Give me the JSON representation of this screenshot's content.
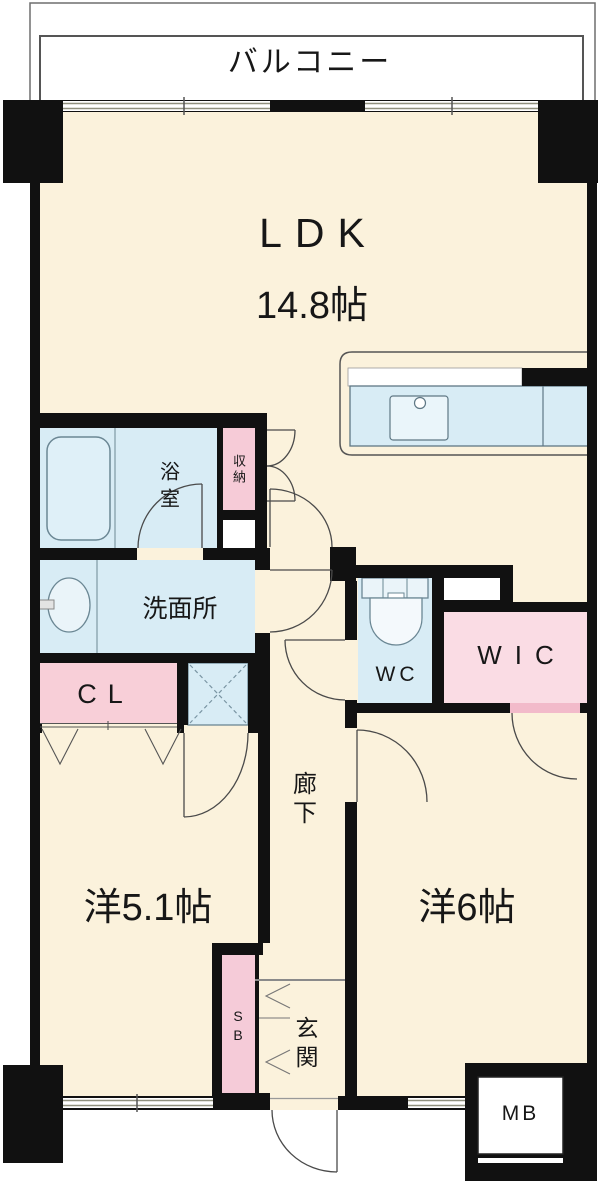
{
  "floor_plan": {
    "title": "apartment-floor-plan",
    "balcony": {
      "label": "バルコニー"
    },
    "ldk": {
      "label": "LDK",
      "size": "14.8帖"
    },
    "bathroom": {
      "label": "浴室"
    },
    "storage": {
      "label": "収納"
    },
    "washroom": {
      "label": "洗面所"
    },
    "closet": {
      "label": "CL"
    },
    "toilet": {
      "label": "WC"
    },
    "walk_in_closet": {
      "label": "WIC"
    },
    "corridor": {
      "label": "廊下"
    },
    "western_room_5_1": {
      "label": "洋5.1帖"
    },
    "entrance": {
      "label": "玄関"
    },
    "shoe_box": {
      "label": "SB"
    },
    "western_room_6": {
      "label": "洋6帖"
    },
    "meter_box": {
      "label": "MB"
    },
    "colors": {
      "wall": "#111111",
      "floor": "#FBF2DC",
      "wet_area_blue": "#D8ECF5",
      "closet_pink": "#F8CFD8",
      "wic_pink": "#FADCE4",
      "storage_pink": "#F6CBD7",
      "background": "#FFFFFF"
    }
  }
}
